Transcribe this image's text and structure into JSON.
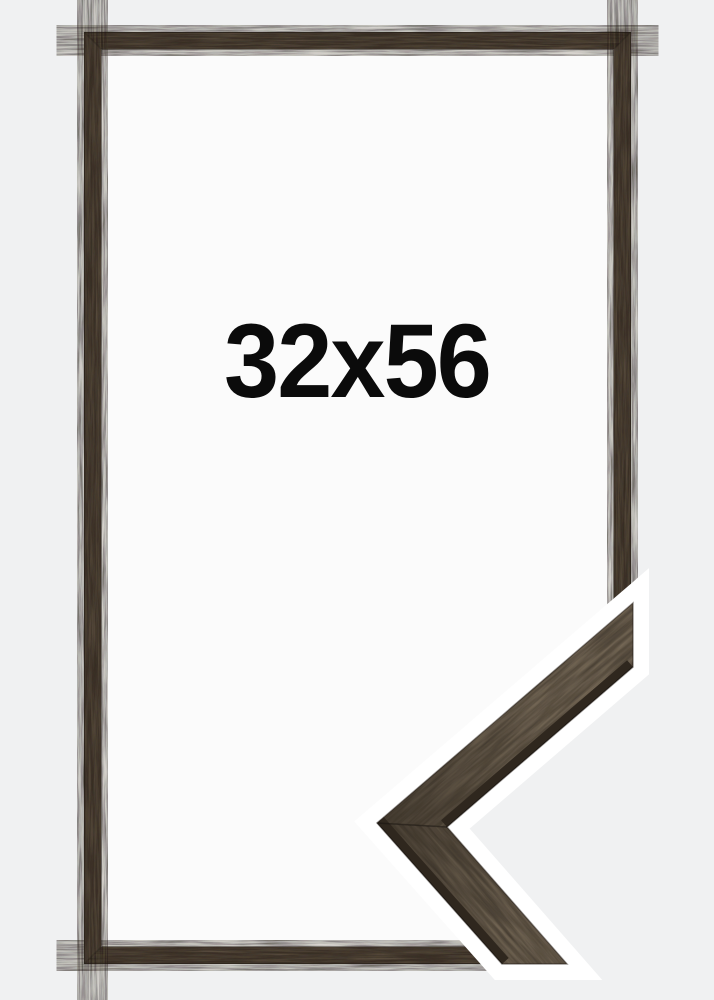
{
  "product_image": {
    "size_label": "32x56",
    "colors": {
      "background": "#f0f1f2",
      "frame_opening": "#fbfbfb",
      "frame_wood": "#4b4135",
      "detail_wood": "#6b5e4f",
      "detail_edge": "#2f271e",
      "halo": "#ffffff",
      "label_text": "#0b0b0b"
    }
  }
}
